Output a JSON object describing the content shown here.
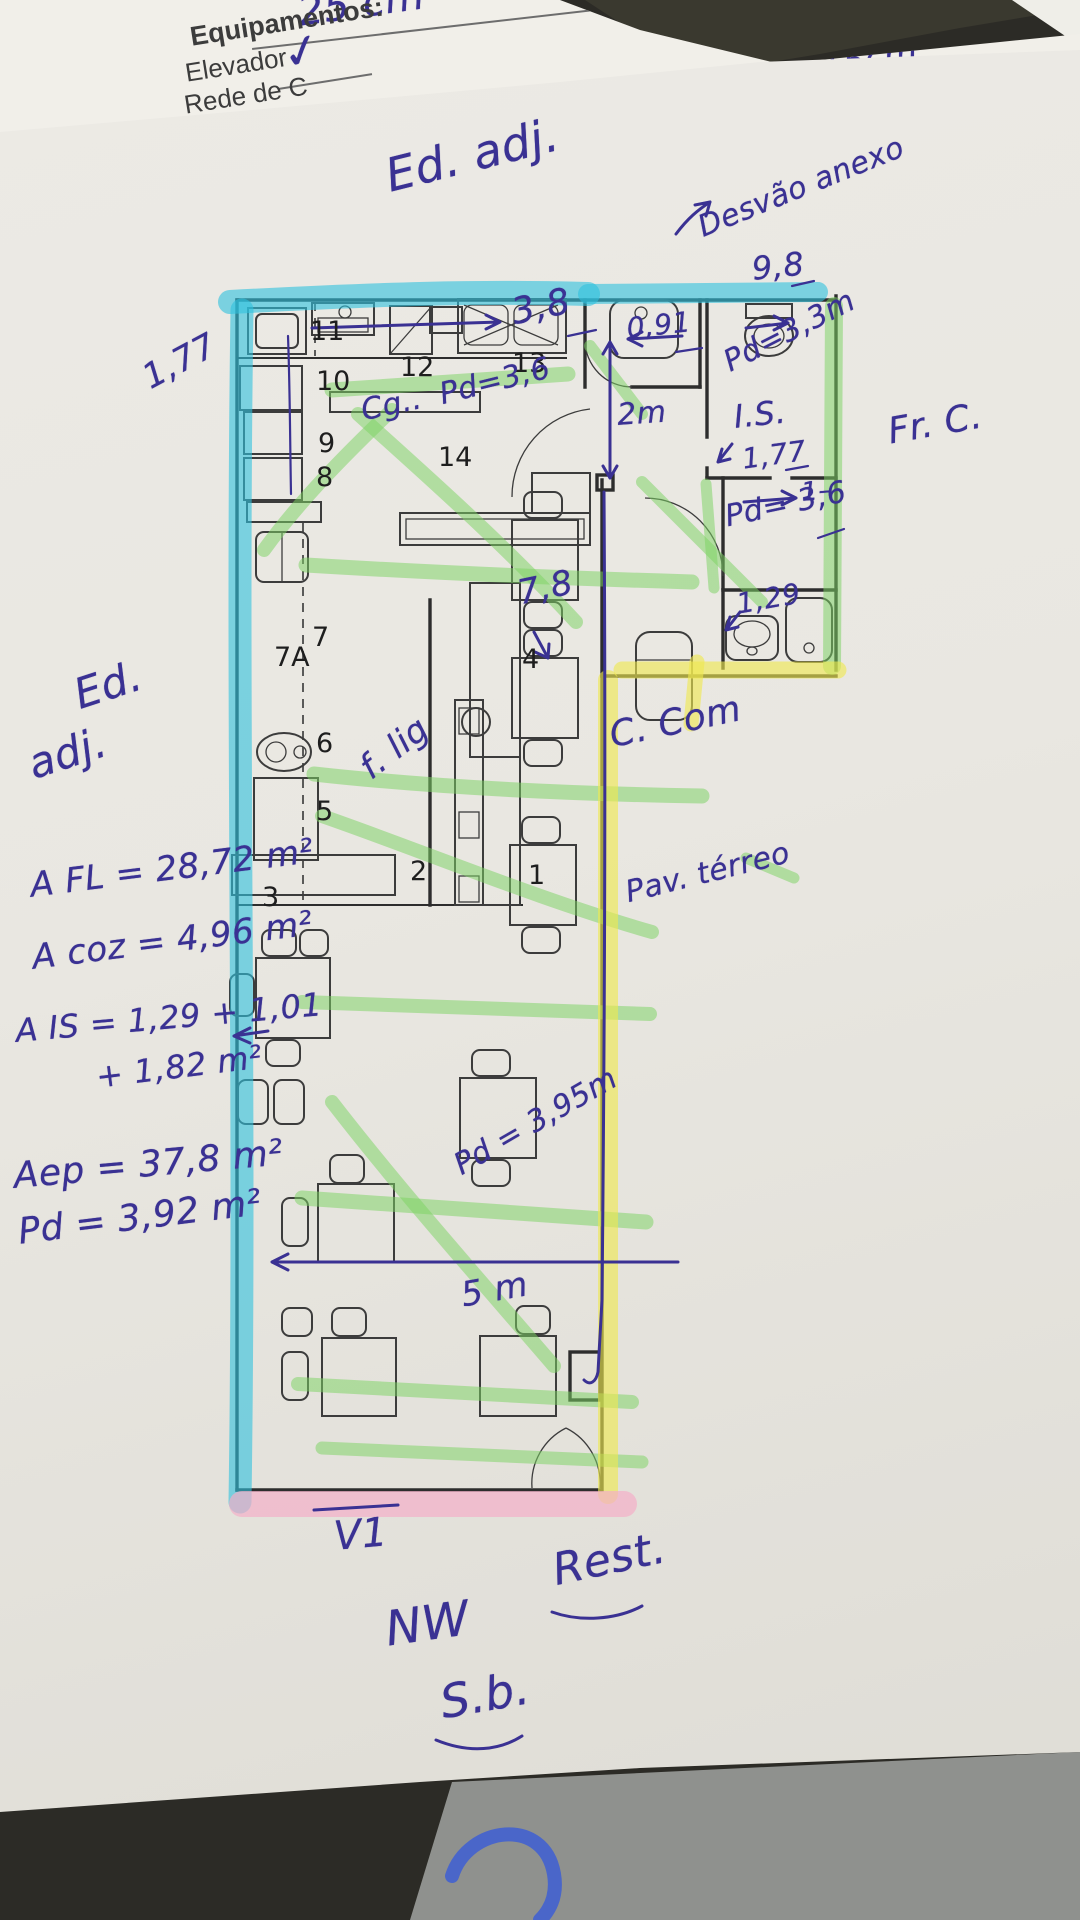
{
  "colors": {
    "ink": "#3a3193",
    "wall": "#2d2d2d",
    "cyan": "#2fc2de",
    "green": "#7cd364",
    "yellow": "#efe94f",
    "pink": "#f4aec7",
    "paper": "#e9e7e1"
  },
  "form_header": {
    "left": {
      "title": "Equipamentos:",
      "item1": "Elevador",
      "check": "✓",
      "item2": "Rede de C",
      "hand_note": "25 cm"
    },
    "right": {
      "label": "teriores CC / Ed. adj. Etc.:",
      "field_prefix": "ra:",
      "field_value": "15cm"
    }
  },
  "plan_labels": [
    {
      "n": "room-label-11",
      "t": "11",
      "x": 310,
      "y": 316
    },
    {
      "n": "room-label-12",
      "t": "12",
      "x": 400,
      "y": 352
    },
    {
      "n": "room-label-13",
      "t": "13",
      "x": 512,
      "y": 348
    },
    {
      "n": "room-label-14",
      "t": "14",
      "x": 438,
      "y": 442
    },
    {
      "n": "room-label-10",
      "t": "10",
      "x": 316,
      "y": 366
    },
    {
      "n": "room-label-9",
      "t": "9",
      "x": 318,
      "y": 428
    },
    {
      "n": "room-label-8",
      "t": "8",
      "x": 316,
      "y": 462
    },
    {
      "n": "room-label-7",
      "t": "7",
      "x": 312,
      "y": 622
    },
    {
      "n": "room-label-7A",
      "t": "7A",
      "x": 274,
      "y": 642
    },
    {
      "n": "room-label-6",
      "t": "6",
      "x": 316,
      "y": 728
    },
    {
      "n": "room-label-5",
      "t": "5",
      "x": 316,
      "y": 796
    },
    {
      "n": "room-label-4",
      "t": "4",
      "x": 522,
      "y": 644
    },
    {
      "n": "room-label-1",
      "t": "1",
      "x": 528,
      "y": 860
    },
    {
      "n": "room-label-2",
      "t": "2",
      "x": 410,
      "y": 856
    },
    {
      "n": "room-label-3",
      "t": "3",
      "x": 262,
      "y": 882
    }
  ],
  "annotations": [
    {
      "n": "note-ed-adj-top",
      "t": "Ed. adj.",
      "x": 380,
      "y": 150,
      "r": -14,
      "s": 46
    },
    {
      "n": "note-desvao-anexo",
      "t": "Desvão anexo",
      "x": 693,
      "y": 212,
      "r": -22,
      "s": 30
    },
    {
      "n": "note-9-8",
      "t": "9,8",
      "x": 750,
      "y": 250,
      "r": -6,
      "s": 32
    },
    {
      "n": "note-pd-3-3",
      "t": "Pd=3,3m",
      "x": 718,
      "y": 348,
      "r": -27,
      "s": 30
    },
    {
      "n": "note-is",
      "t": "I.S.",
      "x": 732,
      "y": 398,
      "r": -6,
      "s": 32
    },
    {
      "n": "note-1-77-right",
      "t": "1,77",
      "x": 740,
      "y": 443,
      "r": -8,
      "s": 28
    },
    {
      "n": "note-1-dash",
      "t": "1–",
      "x": 800,
      "y": 478,
      "r": -5,
      "s": 26
    },
    {
      "n": "note-pd-3-6-right",
      "t": "Pd= 3,6",
      "x": 722,
      "y": 500,
      "r": -12,
      "s": 30
    },
    {
      "n": "note-fr-c",
      "t": "Fr. C.",
      "x": 885,
      "y": 412,
      "r": -10,
      "s": 36
    },
    {
      "n": "note-0-91",
      "t": "0,91",
      "x": 625,
      "y": 312,
      "r": -6,
      "s": 28
    },
    {
      "n": "note-3-8",
      "t": "3,8",
      "x": 508,
      "y": 293,
      "r": -12,
      "s": 36
    },
    {
      "n": "note-2m",
      "t": "2m",
      "x": 616,
      "y": 398,
      "r": -4,
      "s": 30
    },
    {
      "n": "note-cg",
      "t": "Cg..",
      "x": 358,
      "y": 394,
      "r": -12,
      "s": 30
    },
    {
      "n": "note-pd-3-6-kitchen",
      "t": "Pd=3,6",
      "x": 436,
      "y": 378,
      "r": -14,
      "s": 30
    },
    {
      "n": "note-1-77-left",
      "t": "1,77",
      "x": 136,
      "y": 362,
      "r": -28,
      "s": 34
    },
    {
      "n": "note-7-8",
      "t": "7,8",
      "x": 514,
      "y": 574,
      "r": -12,
      "s": 34
    },
    {
      "n": "note-f-lig",
      "t": "f. lig",
      "x": 352,
      "y": 756,
      "r": -38,
      "s": 34
    },
    {
      "n": "note-ed-left",
      "t": "Ed.",
      "x": 68,
      "y": 672,
      "r": -18,
      "s": 42
    },
    {
      "n": "note-adj-left",
      "t": "adj.",
      "x": 22,
      "y": 742,
      "r": -18,
      "s": 42
    },
    {
      "n": "note-area-fl",
      "t": "A FL = 28,72 m²",
      "x": 28,
      "y": 866,
      "r": -7,
      "s": 34
    },
    {
      "n": "note-area-coz",
      "t": "A coz = 4,96 m²",
      "x": 30,
      "y": 938,
      "r": -7,
      "s": 34
    },
    {
      "n": "note-area-is",
      "t": "A IS = 1,29 + 1,01",
      "x": 14,
      "y": 1012,
      "r": -5,
      "s": 32
    },
    {
      "n": "note-area-is2",
      "t": "+ 1,82 m²",
      "x": 94,
      "y": 1058,
      "r": -7,
      "s": 32
    },
    {
      "n": "note-area-ep",
      "t": "Aep = 37,8 m²",
      "x": 12,
      "y": 1156,
      "r": -5,
      "s": 36
    },
    {
      "n": "note-pd-3-92",
      "t": "Pd = 3,92 m²",
      "x": 16,
      "y": 1212,
      "r": -7,
      "s": 36
    },
    {
      "n": "note-c-com",
      "t": "C. Com",
      "x": 606,
      "y": 716,
      "r": -12,
      "s": 36
    },
    {
      "n": "note-pav-terreo",
      "t": "Pav. térreo",
      "x": 622,
      "y": 876,
      "r": -14,
      "s": 30
    },
    {
      "n": "note-pd-3-95",
      "t": "Pd = 3,95m",
      "x": 448,
      "y": 1152,
      "r": -30,
      "s": 30
    },
    {
      "n": "note-5m",
      "t": "5 m",
      "x": 458,
      "y": 1276,
      "r": -10,
      "s": 34
    },
    {
      "n": "note-1-29",
      "t": "1,29",
      "x": 734,
      "y": 588,
      "r": -10,
      "s": 28
    },
    {
      "n": "note-v1",
      "t": "V1",
      "x": 332,
      "y": 1514,
      "r": -5,
      "s": 40
    },
    {
      "n": "note-nw",
      "t": "NW",
      "x": 382,
      "y": 1602,
      "r": -8,
      "s": 48
    },
    {
      "n": "note-sb",
      "t": "S.b.",
      "x": 436,
      "y": 1676,
      "r": -10,
      "s": 46
    },
    {
      "n": "note-rest",
      "t": "Rest.",
      "x": 548,
      "y": 1546,
      "r": -12,
      "s": 44
    }
  ]
}
